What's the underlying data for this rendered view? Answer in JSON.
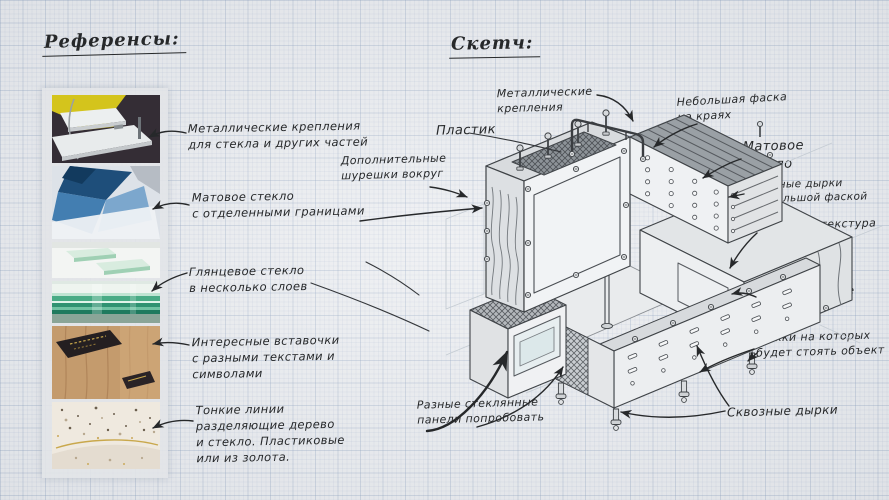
{
  "colors": {
    "paper": "#eaecef",
    "grid_minor": "#dfe5ec",
    "grid_major": "#c7d2de",
    "ink": "#26282a",
    "pencil": "#4a4e53",
    "panel": "#e2e4e8",
    "ref_yellow": "#d4c41c",
    "ref_blue": "#2e6fa8",
    "ref_glass_green": "#49ab85",
    "ref_wood": "#c49b6d",
    "ref_gold": "#c9a84c"
  },
  "headings": {
    "references": "Референсы:",
    "sketch": "Скетч:"
  },
  "reference_images": [
    {
      "name": "white-shelf-metal-fixings-photo"
    },
    {
      "name": "blue-frosted-glass-cubes-photo"
    },
    {
      "name": "green-glass-floating-shelves-photo"
    },
    {
      "name": "layered-green-glass-edge-photo"
    },
    {
      "name": "wood-with-text-insert-photo"
    },
    {
      "name": "speckled-surface-gold-line-photo"
    }
  ],
  "reference_notes": [
    {
      "text": "Металлические крепления\nдля стекла и других частей"
    },
    {
      "text": "Матовое стекло\nс отделенными границами"
    },
    {
      "text": "Глянцевое стекло\nв несколько слоев"
    },
    {
      "text": "Интересные вставочки\nс разными текстами и\nсимволами"
    },
    {
      "text": "Тонкие линии\nразделяющие дерево\nи стекло. Пластиковые\nили из золота."
    }
  ],
  "sketch_labels": [
    {
      "id": "metal-fixings-top",
      "text": "Металлические\nкрепления"
    },
    {
      "id": "plastic",
      "text": "Пластик"
    },
    {
      "id": "extra-screws",
      "text": "Дополнительные\nшурешки вокруг"
    },
    {
      "id": "small-chamfer",
      "text": "Небольшая фаска\nна краях"
    },
    {
      "id": "matte-glass",
      "text": "Матовое\nстекло"
    },
    {
      "id": "through-holes-chamfer",
      "text": "Сквозные дырки\nс небольшой фаской"
    },
    {
      "id": "wood-texture",
      "text": "Основная текстура\nдерево"
    },
    {
      "id": "metal-fixings-right",
      "text": "Металлические\nкрепления"
    },
    {
      "id": "legs",
      "text": "Ножки на которых\nбудет стоять объект"
    },
    {
      "id": "through-holes-bottom",
      "text": "Сквозные дырки"
    },
    {
      "id": "glass-panels",
      "text": "Разные стеклянные\nпанели попробовать"
    }
  ]
}
